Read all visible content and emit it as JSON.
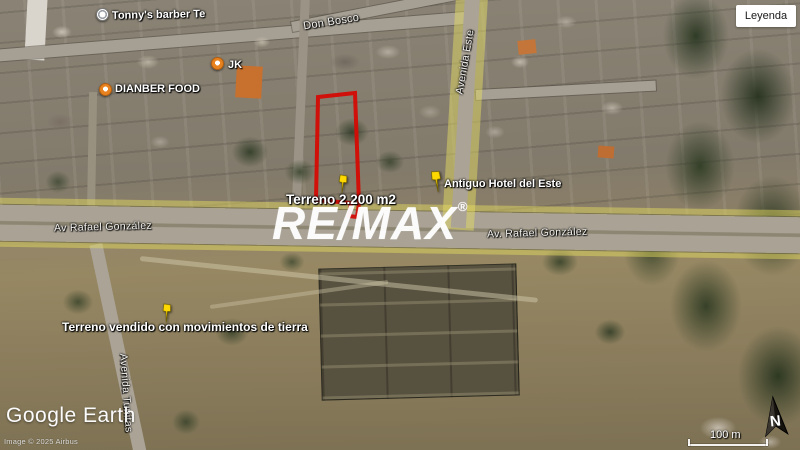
{
  "legend": {
    "label": "Leyenda"
  },
  "watermark": {
    "brand": "RE/MAX",
    "registered": "®"
  },
  "streets": {
    "don_bosco": "Don Bosco",
    "avenida_este": "Avenida Este",
    "av_rafael_left": "Av Rafael González",
    "av_rafael_right": "Av. Rafael González",
    "avenida_sw": "Avenida Tunitas"
  },
  "places": {
    "tonnys": "Tonny's barber Te",
    "jk": "JK",
    "dianber": "DIANBER FOOD",
    "hotel": "Antiguo Hotel del Este"
  },
  "annotations": {
    "parcel_area": "Terreno 2.200 m2",
    "sold_parcel": "Terreno vendido con movimientos de tierra"
  },
  "attribution": {
    "logo": "Google Earth",
    "copyright": "Image © 2025 Airbus"
  },
  "scale_bar": {
    "label": "100 m"
  },
  "compass": {
    "label": "N"
  },
  "colors": {
    "parcel_outline": "#d40b04",
    "road_highlight": "#e7de5f",
    "pin_yellow": "#ffd800",
    "poi_orange": "#e8821e"
  }
}
